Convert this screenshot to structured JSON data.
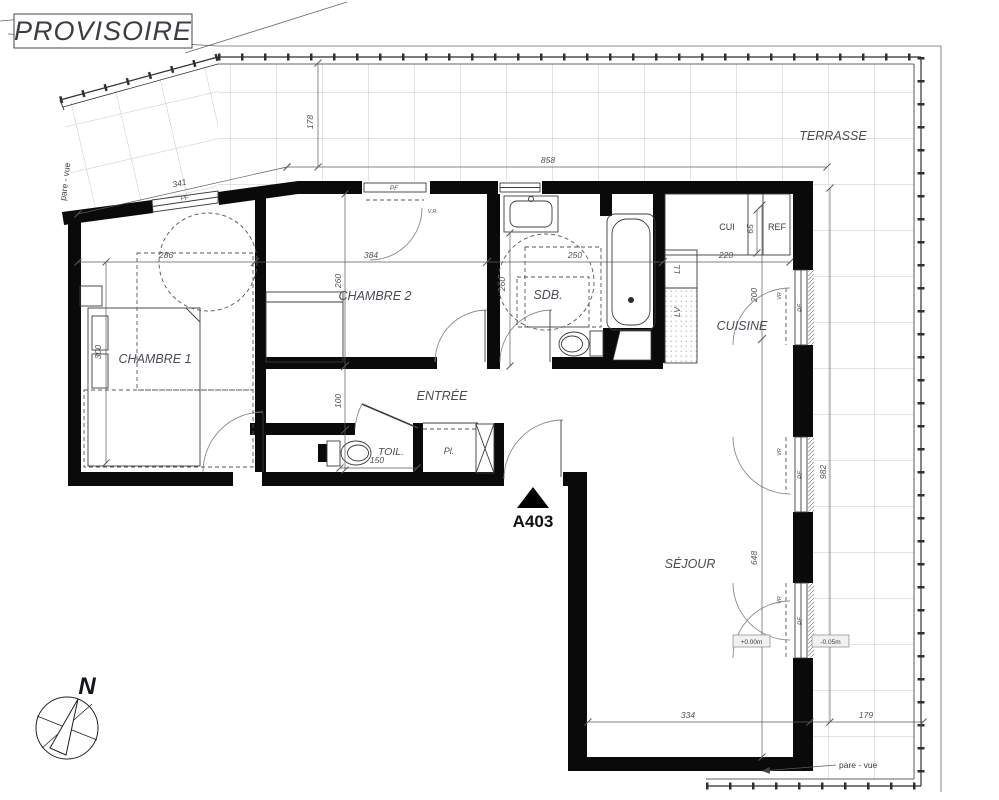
{
  "stamp": {
    "label": "PROVISOIRE"
  },
  "unit": {
    "id": "A403"
  },
  "compass": {
    "north": "N"
  },
  "rooms": {
    "terrasse": "TERRASSE",
    "chambre1": "CHAMBRE 1",
    "chambre2": "CHAMBRE 2",
    "sdb": "SDB.",
    "entree": "ENTRÉE",
    "toil": "TOIL.",
    "placard": "Pl.",
    "cuisine": "CUISINE",
    "sejour": "SÉJOUR"
  },
  "fixtures": {
    "kitchen_unit": "CUI",
    "fridge": "REF",
    "washer": "LL",
    "dishwasher": "LV"
  },
  "openings": {
    "window": "PF",
    "shutter": "VR",
    "shutter_dotted": "V.R"
  },
  "levels": {
    "interior": "+0.00m",
    "terrace": "-0.05m"
  },
  "notes": {
    "privacy_screen": "pare - vue"
  },
  "dims": {
    "terrace_width": "858",
    "terrace_depth": "178",
    "terrace_side": "982",
    "terrace_bottom": "179",
    "slant_window": "341",
    "ch1_width": "286",
    "ch1_depth": "300",
    "ch2_width": "384",
    "ch2_depth": "260",
    "sdb_width": "250",
    "sdb_depth": "260",
    "kitchen_width": "220",
    "kitchen_depth": "200",
    "fridge_width": "65",
    "hall_depth": "100",
    "toil_width": "150",
    "sejour_depth": "648",
    "sejour_width": "334"
  }
}
